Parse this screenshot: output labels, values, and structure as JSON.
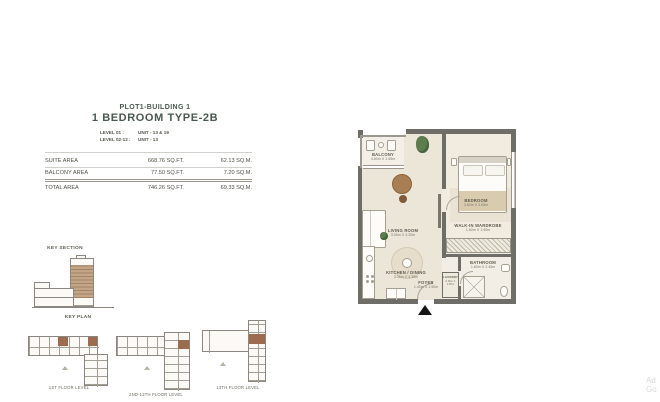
{
  "header": {
    "plot": "PLOT1-BUILDING 1",
    "type": "1 BEDROOM TYPE-2B",
    "levels": [
      {
        "label": "LEVEL 01 :",
        "value": "UNIT - 13 & 19"
      },
      {
        "label": "LEVEL 02-12 :",
        "value": "UNIT - 13"
      }
    ]
  },
  "area_table": {
    "rows": [
      {
        "label": "SUITE AREA",
        "sqft": "668.76 SQ.FT.",
        "sqm": "62.13 SQ.M."
      },
      {
        "label": "BALCONY AREA",
        "sqft": "77.50 SQ.FT.",
        "sqm": "7.20 SQ.M."
      },
      {
        "label": "TOTAL AREA",
        "sqft": "746.26 SQ.FT.",
        "sqm": "69.33 SQ.M."
      }
    ]
  },
  "key_section": {
    "title": "KEY SECTION"
  },
  "key_plan": {
    "title": "KEY PLAN",
    "floors": [
      {
        "caption": "1ST FLOOR LEVEL"
      },
      {
        "caption": "2ND-12TH FLOOR LEVEL"
      },
      {
        "caption": "13TH FLOOR LEVEL"
      }
    ]
  },
  "floorplan": {
    "rooms": {
      "balcony": {
        "name": "BALCONY",
        "dims": "4.60m X 1.55m"
      },
      "bedroom": {
        "name": "BEDROOM",
        "dims": "3.60m X 3.05m"
      },
      "living": {
        "name": "LIVING ROOM",
        "dims": "3.05m X 3.20m"
      },
      "kitchen": {
        "name": "KITCHEN / DINING",
        "dims": "3.35m X 4.35m"
      },
      "wardrobe": {
        "name": "WALK-IN WARDROBE",
        "dims": "1.60m X 1.90m"
      },
      "bathroom": {
        "name": "BATHROOM",
        "dims": "1.60m X 2.45m"
      },
      "foyer": {
        "name": "FOYER",
        "dims": "1.40m X 1.50m"
      },
      "laundry": {
        "name": "LAUNDRY",
        "dims": "0.90m X 1.55m"
      }
    }
  },
  "watermark": {
    "line1": "Ad",
    "line2": "Go"
  },
  "colors": {
    "accent_title": "#4a594f",
    "wall": "#6f6d68",
    "highlight_unit": "#9d6b4e",
    "highlight_floors": "#c3a687"
  }
}
